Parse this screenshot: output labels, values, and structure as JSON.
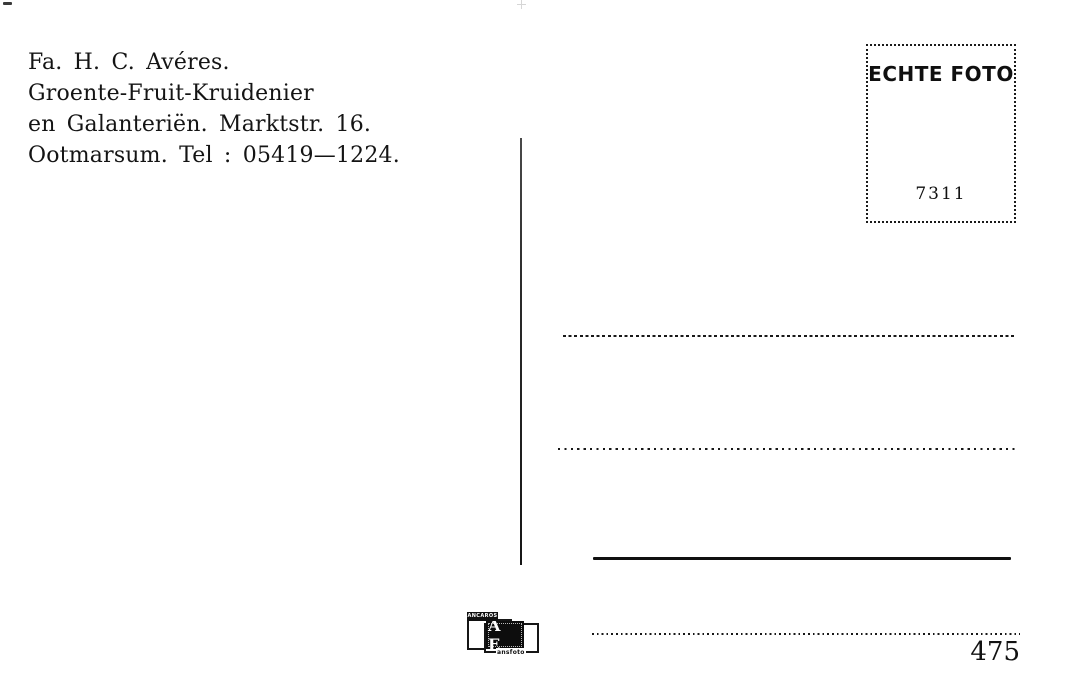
{
  "postcard": {
    "publisher": {
      "lines": [
        "Fa. H. C. Avéres.",
        "Groente-Fruit-Kruidenier",
        "en Galanteriën. Marktstr. 16.",
        "Ootmarsum. Tel : 05419—1224."
      ]
    },
    "stamp_box": {
      "label": "ECHTE FOTO",
      "number": "7311"
    },
    "card_number": "475",
    "publisher_logo": {
      "monogram": "A E",
      "top_text_illegible": "ANCAROS",
      "bottom_text_illegible": "ansfoto"
    },
    "colors": {
      "ink": "#161616",
      "paper": "#ffffff"
    }
  }
}
